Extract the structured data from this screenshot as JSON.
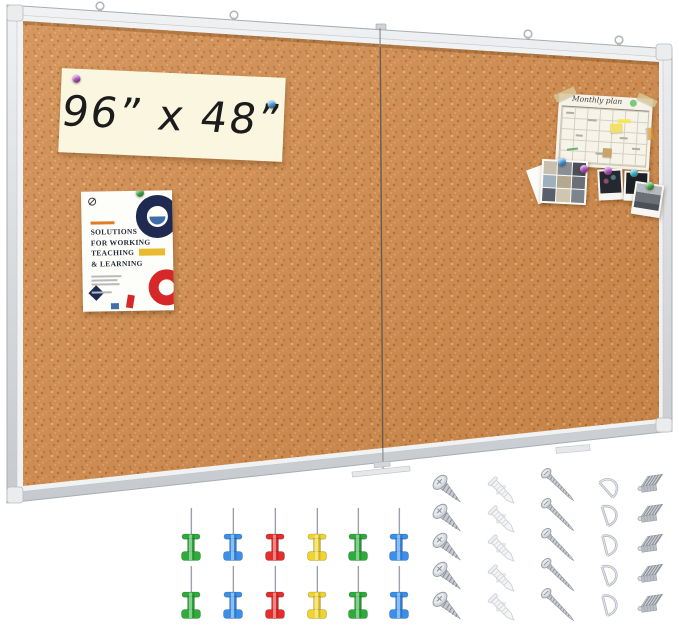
{
  "scene": {
    "description": "Product photo of a large wall-mounted dual-panel cork bulletin board with mounting hardware and push pins",
    "background_color": "#ffffff"
  },
  "board": {
    "size_label": "96” x 48”",
    "panel_count": 2,
    "hanging_loop_count": 4,
    "frame_color": "#dfe2e5",
    "cork_color": "#d18c4d"
  },
  "size_sign": {
    "text": "96” x 48”",
    "paper_color": "#faf6df",
    "pin_colors": [
      "purple",
      "blue"
    ]
  },
  "poster": {
    "title_lines": [
      "SOLUTIONS",
      "FOR WORKING",
      "TEACHING",
      "& LEARNING"
    ],
    "pin_color": "green",
    "accent_colors": {
      "navy": "#1e2a52",
      "steel_blue": "#3f6ea8",
      "red": "#d62828",
      "yellow": "#e9ba2f",
      "orange": "#e07b28"
    }
  },
  "calendar": {
    "title": "Monthly plan",
    "sticker_color": "#7ec87e",
    "note_colors": [
      "#f3e06a",
      "#c9a36a",
      "#69b06a"
    ]
  },
  "photo_collage": {
    "thumb_count": 9,
    "pin_colors": [
      "blue",
      "purple"
    ],
    "thumb_tones": [
      "#c8bfae",
      "#8a8f96",
      "#4a4f58",
      "#9fb0bd",
      "#b4a98f",
      "#6a6f78",
      "#57606b",
      "#cfc6b2",
      "#7d848c"
    ]
  },
  "polaroids": {
    "count": 3,
    "pin_colors": [
      "purple",
      "teal",
      "green"
    ],
    "photo_tones": [
      "#262830",
      "#1d2026",
      "#9aa0a8"
    ]
  },
  "pin_palette": {
    "purple": "#b24fc8",
    "blue": "#3f9be2",
    "green": "#3fae4a",
    "teal": "#3fb6c8"
  },
  "push_pins": {
    "count": 12,
    "rows": 2,
    "row_colors": [
      "#2fab3c",
      "#3b8fe8",
      "#e42e2e",
      "#efd32f",
      "#2fab3c",
      "#3b8fe8"
    ],
    "color_names": [
      "green",
      "blue",
      "red",
      "yellow",
      "green",
      "blue"
    ]
  },
  "hardware": {
    "items": [
      {
        "name": "short-screw",
        "count": 5
      },
      {
        "name": "wall-anchor",
        "count": 5
      },
      {
        "name": "long-screw",
        "count": 5
      },
      {
        "name": "d-ring",
        "count": 5
      },
      {
        "name": "sawtooth-clip",
        "count": 5
      }
    ]
  }
}
